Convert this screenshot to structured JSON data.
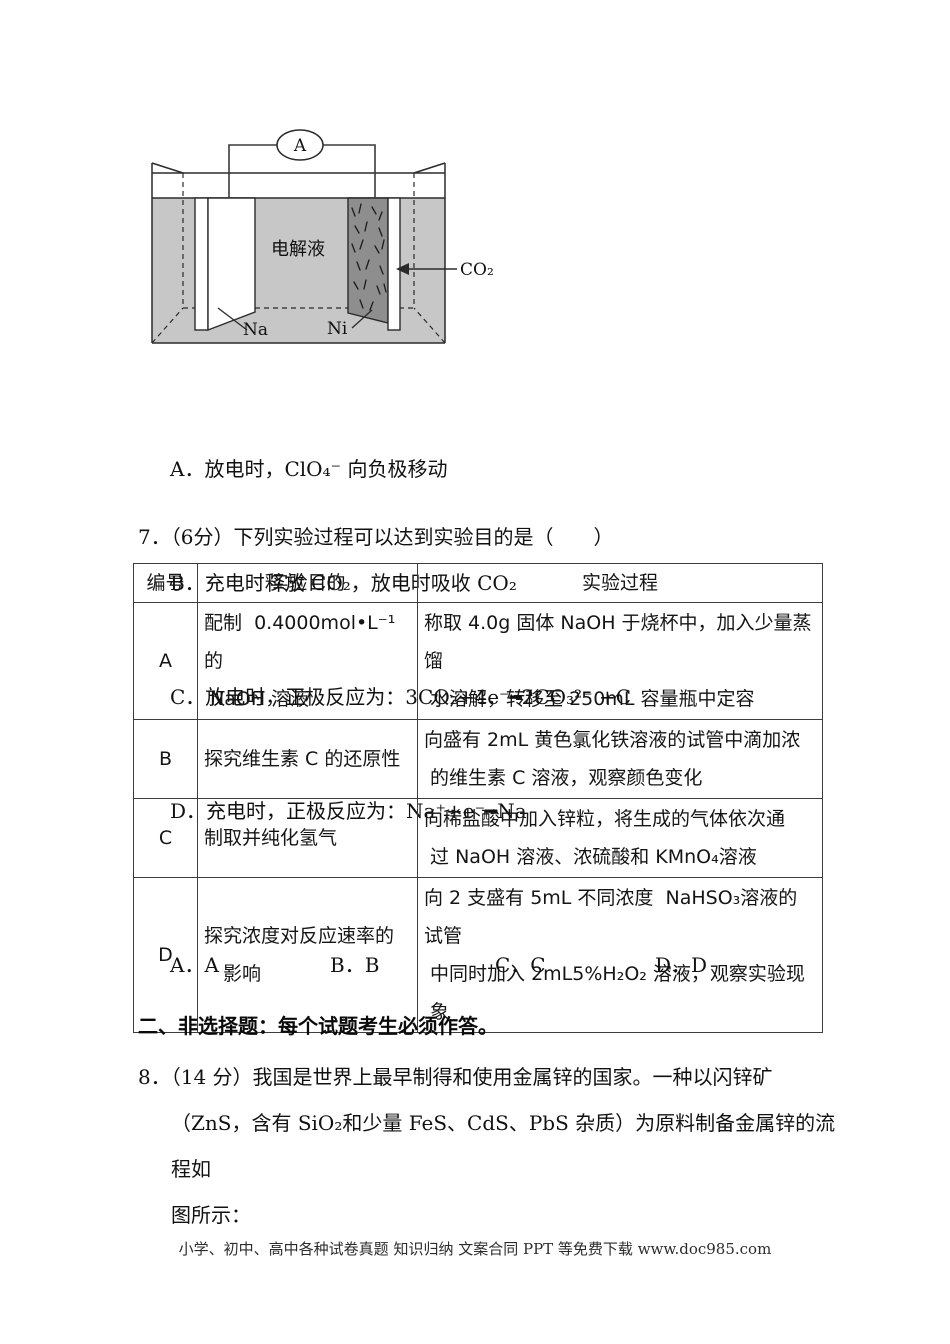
{
  "colors": {
    "liquid_gray": "#c7c7c7",
    "electrode_dark": "#8e8e8e",
    "line_black": "#2b2b2b",
    "table_border": "#3d3d3d"
  },
  "diagram": {
    "ammeter_label": "A",
    "electrolyte_label": "电解液",
    "left_electrode_label": "Na",
    "right_electrode_label": "Ni",
    "gas_label": "CO₂"
  },
  "question6": {
    "options": [
      "A．放电时，ClO₄⁻ 向负极移动",
      "B．充电时释放 CO₂，放电时吸收 CO₂",
      "C．放电时，正极反应为：3CO₂+4e⁻━2CO₃²⁻ +C",
      "D．充电时，正极反应为：Na⁺+e⁻━Na"
    ]
  },
  "question7": {
    "stem": "7．（6分）下列实验过程可以达到实验目的是（　　）",
    "table": {
      "headers": [
        "编号",
        "实验目的",
        "实验过程"
      ],
      "rows": [
        {
          "id": "A",
          "purpose": "配制  0.4000mol•L⁻¹的\n NaOH 溶液",
          "procedure": "称取 4.0g 固体 NaOH 于烧杯中，加入少量蒸馏\n 水溶解，转移至 250mL 容量瓶中定容"
        },
        {
          "id": "B",
          "purpose": "探究维生素 C 的还原性",
          "procedure": "向盛有 2mL 黄色氯化铁溶液的试管中滴加浓\n 的维生素 C 溶液，观察颜色变化"
        },
        {
          "id": "C",
          "purpose": "制取并纯化氢气",
          "procedure": "向稀盐酸中加入锌粒，将生成的气体依次通\n 过 NaOH 溶液、浓硫酸和 KMnO₄溶液"
        },
        {
          "id": "D",
          "purpose": "探究浓度对反应速率的\n　影响",
          "procedure": "向 2 支盛有 5mL 不同浓度  NaHSO₃溶液的试管\n 中同时加入 2mL5%H₂O₂ 溶液，观察实验现\n 象"
        }
      ]
    },
    "answers": [
      "A．A",
      "B．B",
      "C．C",
      "D．D"
    ]
  },
  "section2_title": "二、非选择题：每个试题考生必须作答。",
  "question8_stem": "8．（14 分）我国是世界上最早制得和使用金属锌的国家。一种以闪锌矿\n（ZnS，含有 SiO₂和少量 FeS、CdS、PbS 杂质）为原料制备金属锌的流程如\n图所示：",
  "footer": "小学、初中、高中各种试卷真题  知识归纳  文案合同  PPT 等免费下载      www.doc985.com"
}
